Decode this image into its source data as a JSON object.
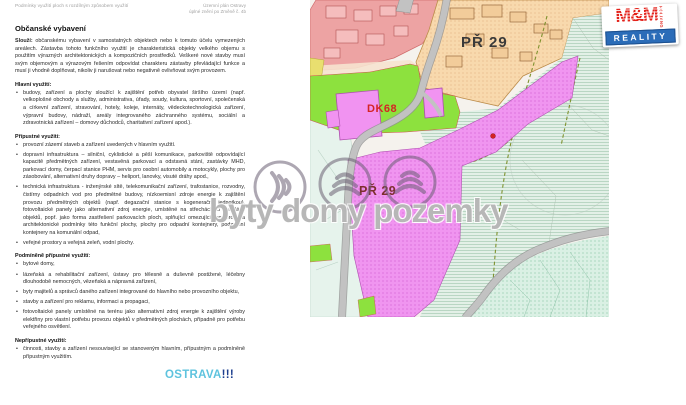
{
  "header": {
    "left": "Podmínky využití ploch s rozdílným způsobem využití",
    "plan_title": "Územní plán Ostravy",
    "plan_subtitle": "úplné znění po Změně č. 4b"
  },
  "document": {
    "title": "Občanské vybavení",
    "intro_label": "Slouží:",
    "intro_text": "občanskému vybavení v samostatných objektech nebo k tomuto účelu vymezených areálech. Zástavba tohoto funkčního využití je charakteristická objekty velkého objemu s použitím výrazných architektonických a kompozičních prostředků. Veškeré nové stavby musí svým objemovým a výrazovým řešením odpovídat charakteru zástavby převládající funkce a musí ji vhodně doplňovat, nikoliv ji narušovat nebo negativně ovlivňovat svým provozem.",
    "sections": [
      {
        "heading": "Hlavní využití:",
        "bullets": [
          "budovy, zařízení a plochy sloužící k zajištění potřeb obyvatel širšího území (např. velkoplošné obchody a služby, administrativa, úřady, soudy, kultura, sportovní, společenská a církevní zařízení, stravování, hotely, koleje, internáty, vědeckotechnologická zařízení, výpravní budovy, nádraží, areály integrovaného záchranného systému, sociální a zdravotnická zařízení – domovy důchodců, charitativní zařízení apod.)."
        ]
      },
      {
        "heading": "Přípustné využití:",
        "bullets": [
          "provozní zázemí staveb a zařízení uvedených v hlavním využití.",
          "dopravní infrastruktura – silniční, cyklistické a pěší komunikace, parkoviště odpovídající kapacitě předmětných zařízení, vestavěná parkovací a odstavná stání, zastávky MHD, parkovací domy, čerpací stanice PHM, servis pro osobní automobily a motocykly, plochy pro zásobování, alternativní druhy dopravy – heliport, lanovky, visuté dráhy apod.,",
          "technická infrastruktura - inženýrské sítě, telekomunikační zařízení, trafostanice, rozvodny, čistírny odpadních vod pro předmětné budovy, nízkoemisní zdroje energie k zajištění provozu předmětných objektů (např. degazační stanice s kogenerační jednotkou), fotovoltaické panely jako alternativní zdroj energie, umístěné na střechách či fasádách objektů, popř. jako forma zastřešení parkovacích ploch, splňující omezující prostorové a architektonické podmínky této funkční plochy, plochy pro odpadní kontejnery, podzemní kontejnery na komunální odpad,",
          "veřejné prostory a veřejná zeleň, vodní plochy."
        ]
      },
      {
        "heading": "Podmíněně přípustné využití:",
        "bullets": [
          "bytové domy,",
          "lázeňská a rehabilitační zařízení, ústavy pro tělesně a duševně postižené, léčebny dlouhodobě nemocných, vězeňská a nápravná zařízení,",
          "byty majitelů a správců daného zařízení integrované do hlavního nebo provozního objektu,",
          "stavby a zařízení pro reklamu, informaci a propagaci,",
          "fotovoltaické panely umístěné na terénu jako alternativní zdroj energie k zajištění výroby elektřiny pro vlastní potřebu provozu objektů v předmětných plochách, případně pro potřebu veřejného osvětlení."
        ]
      },
      {
        "heading": "Nepřípustné využití:",
        "bullets": [
          "činnosti, stavby a zařízení nesouvisející se stanoveným hlavním, přípustným a podmíněně přípustným využitím."
        ]
      }
    ]
  },
  "map": {
    "labels": {
      "zone_top": "PŘ 29",
      "zone_dk": "DK68",
      "zone_bottom": "PŘ 29"
    },
    "colors": {
      "residential_pink": "#eda3a3",
      "civic_peach": "#f8d9ad",
      "greenery_bright": "#8de13e",
      "transport_magenta": "#f095f0",
      "forest_hatch": "#e3f0e7",
      "road_gray": "#c2c2c2",
      "marker_red": "#d42222"
    }
  },
  "watermark": {
    "text": "byty domy pozemky"
  },
  "logos": {
    "mm_reality": {
      "name": "M&M",
      "line2": "REALITY",
      "side": "HOLDING"
    },
    "ostrava": {
      "text": "OSTRAVA",
      "exclamation": "!!!"
    }
  }
}
